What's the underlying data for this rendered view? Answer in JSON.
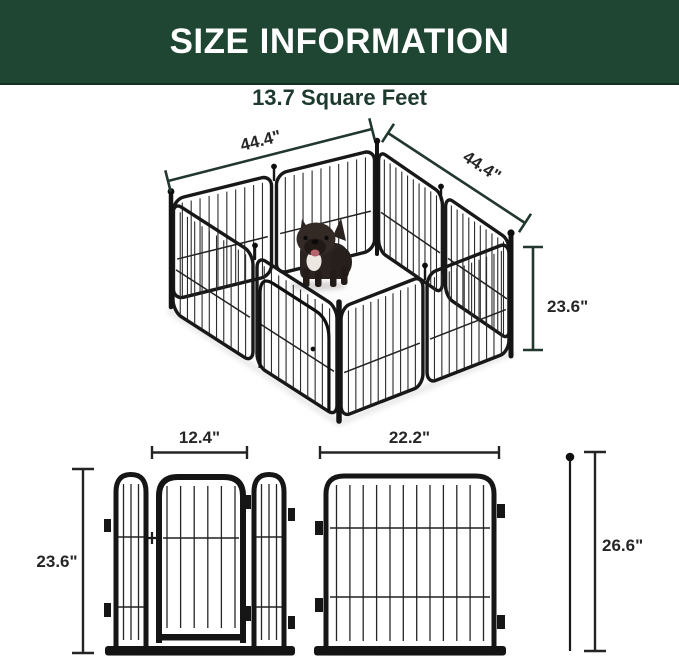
{
  "header": {
    "title": "SIZE INFORMATION"
  },
  "subtitle": "13.7 Square Feet",
  "pen3d": {
    "dim_back_left": "44.4\"",
    "dim_back_right": "44.4\"",
    "dim_height": "23.6\""
  },
  "gate_panel": {
    "dim_width": "12.4\"",
    "dim_height": "23.6\""
  },
  "regular_panel": {
    "dim_width": "22.2\""
  },
  "stake": {
    "dim_height": "26.6\""
  },
  "colors": {
    "header_bg": "#1e4633",
    "header_text": "#ffffff",
    "subtitle_text": "#1e3a2e",
    "dim_line_green": "#22382e",
    "dim_line_dark": "#242424",
    "dim_label": "#262626",
    "metal_frame": "#161616",
    "floor": "#fdfdfd"
  }
}
